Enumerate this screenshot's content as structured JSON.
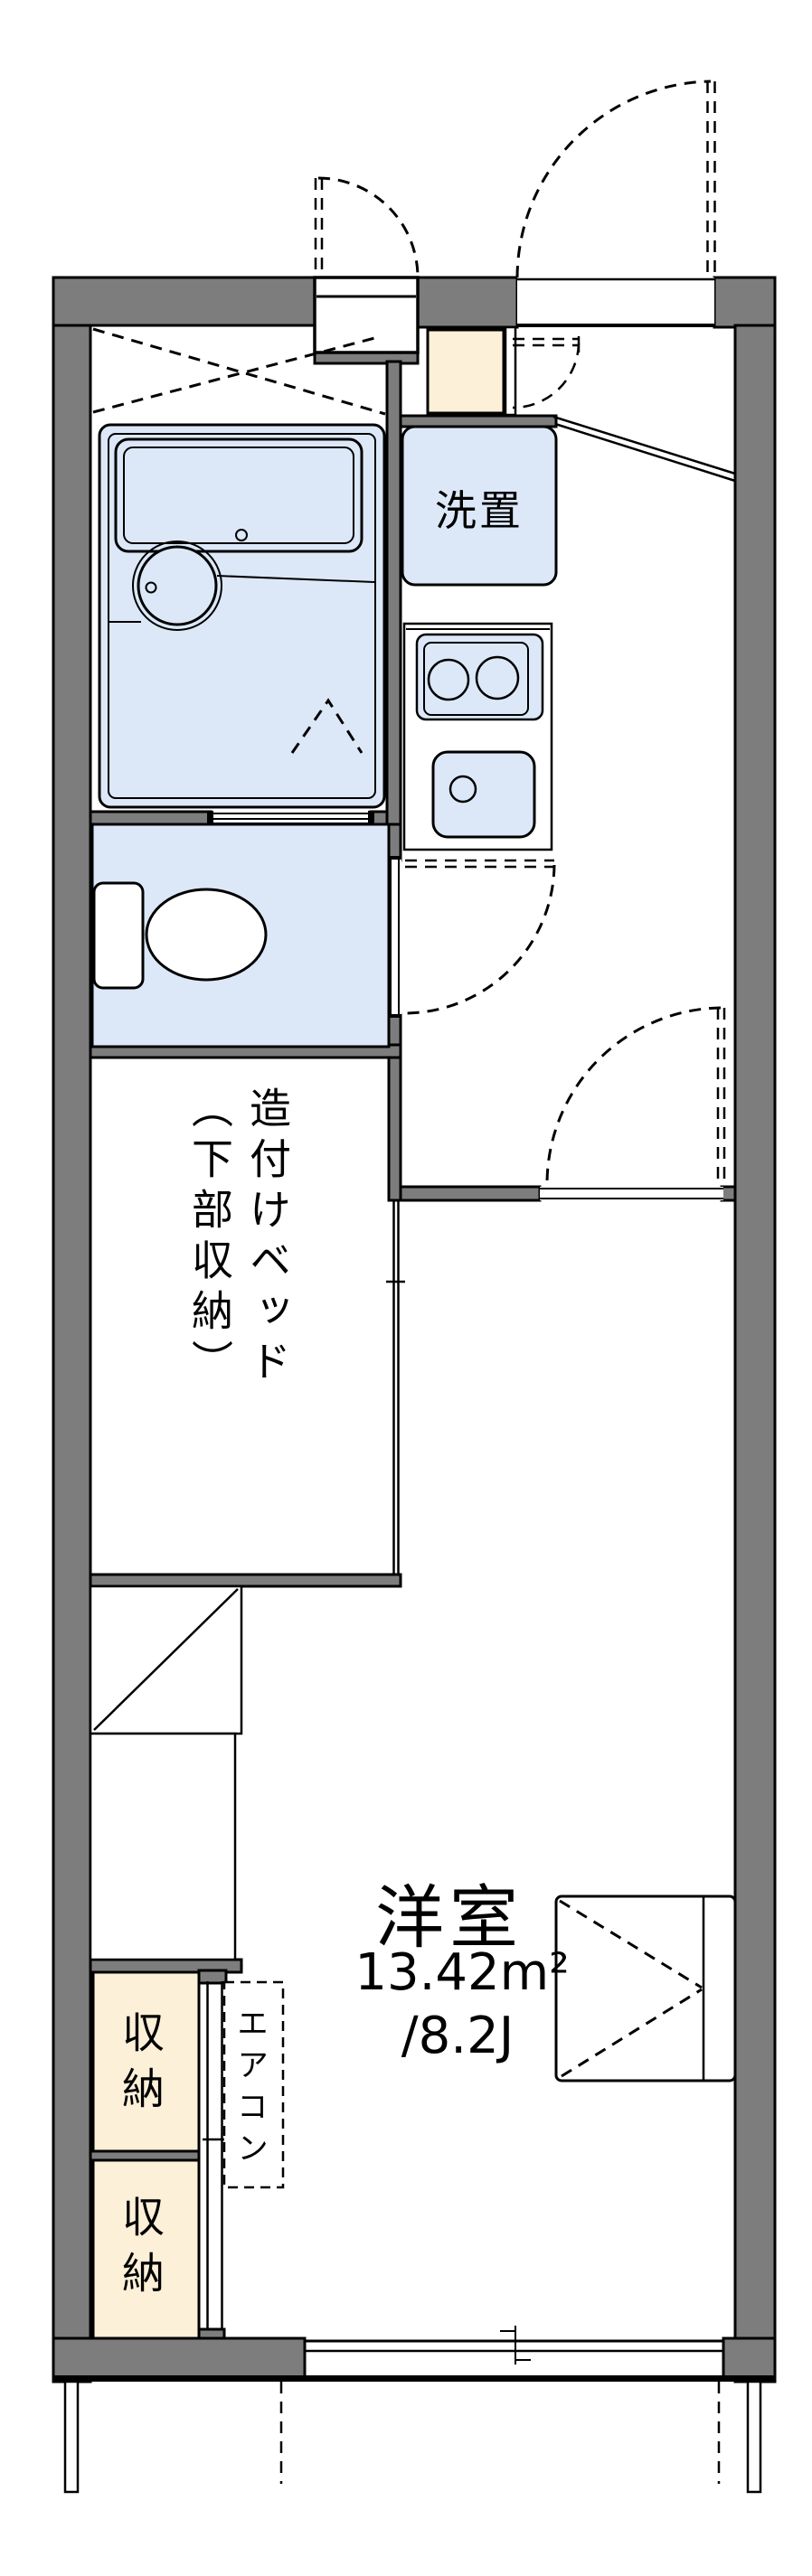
{
  "colors": {
    "wall": "#7d7d7d",
    "water": "#dce8f8",
    "storage": "#fdf0d8",
    "line": "#000000",
    "background": "#ffffff"
  },
  "rooms": {
    "washer_space": {
      "label": "洗置"
    },
    "built_in_bed": {
      "label": "造付けベッド\n（下部収納）"
    },
    "western_room": {
      "name": "洋室",
      "area_sqm": "13.42m²",
      "area_jo": "/8.2J"
    },
    "storage_upper": {
      "label": "収納"
    },
    "storage_lower": {
      "label": "収納"
    },
    "aircon": {
      "label": "エアコン"
    }
  }
}
